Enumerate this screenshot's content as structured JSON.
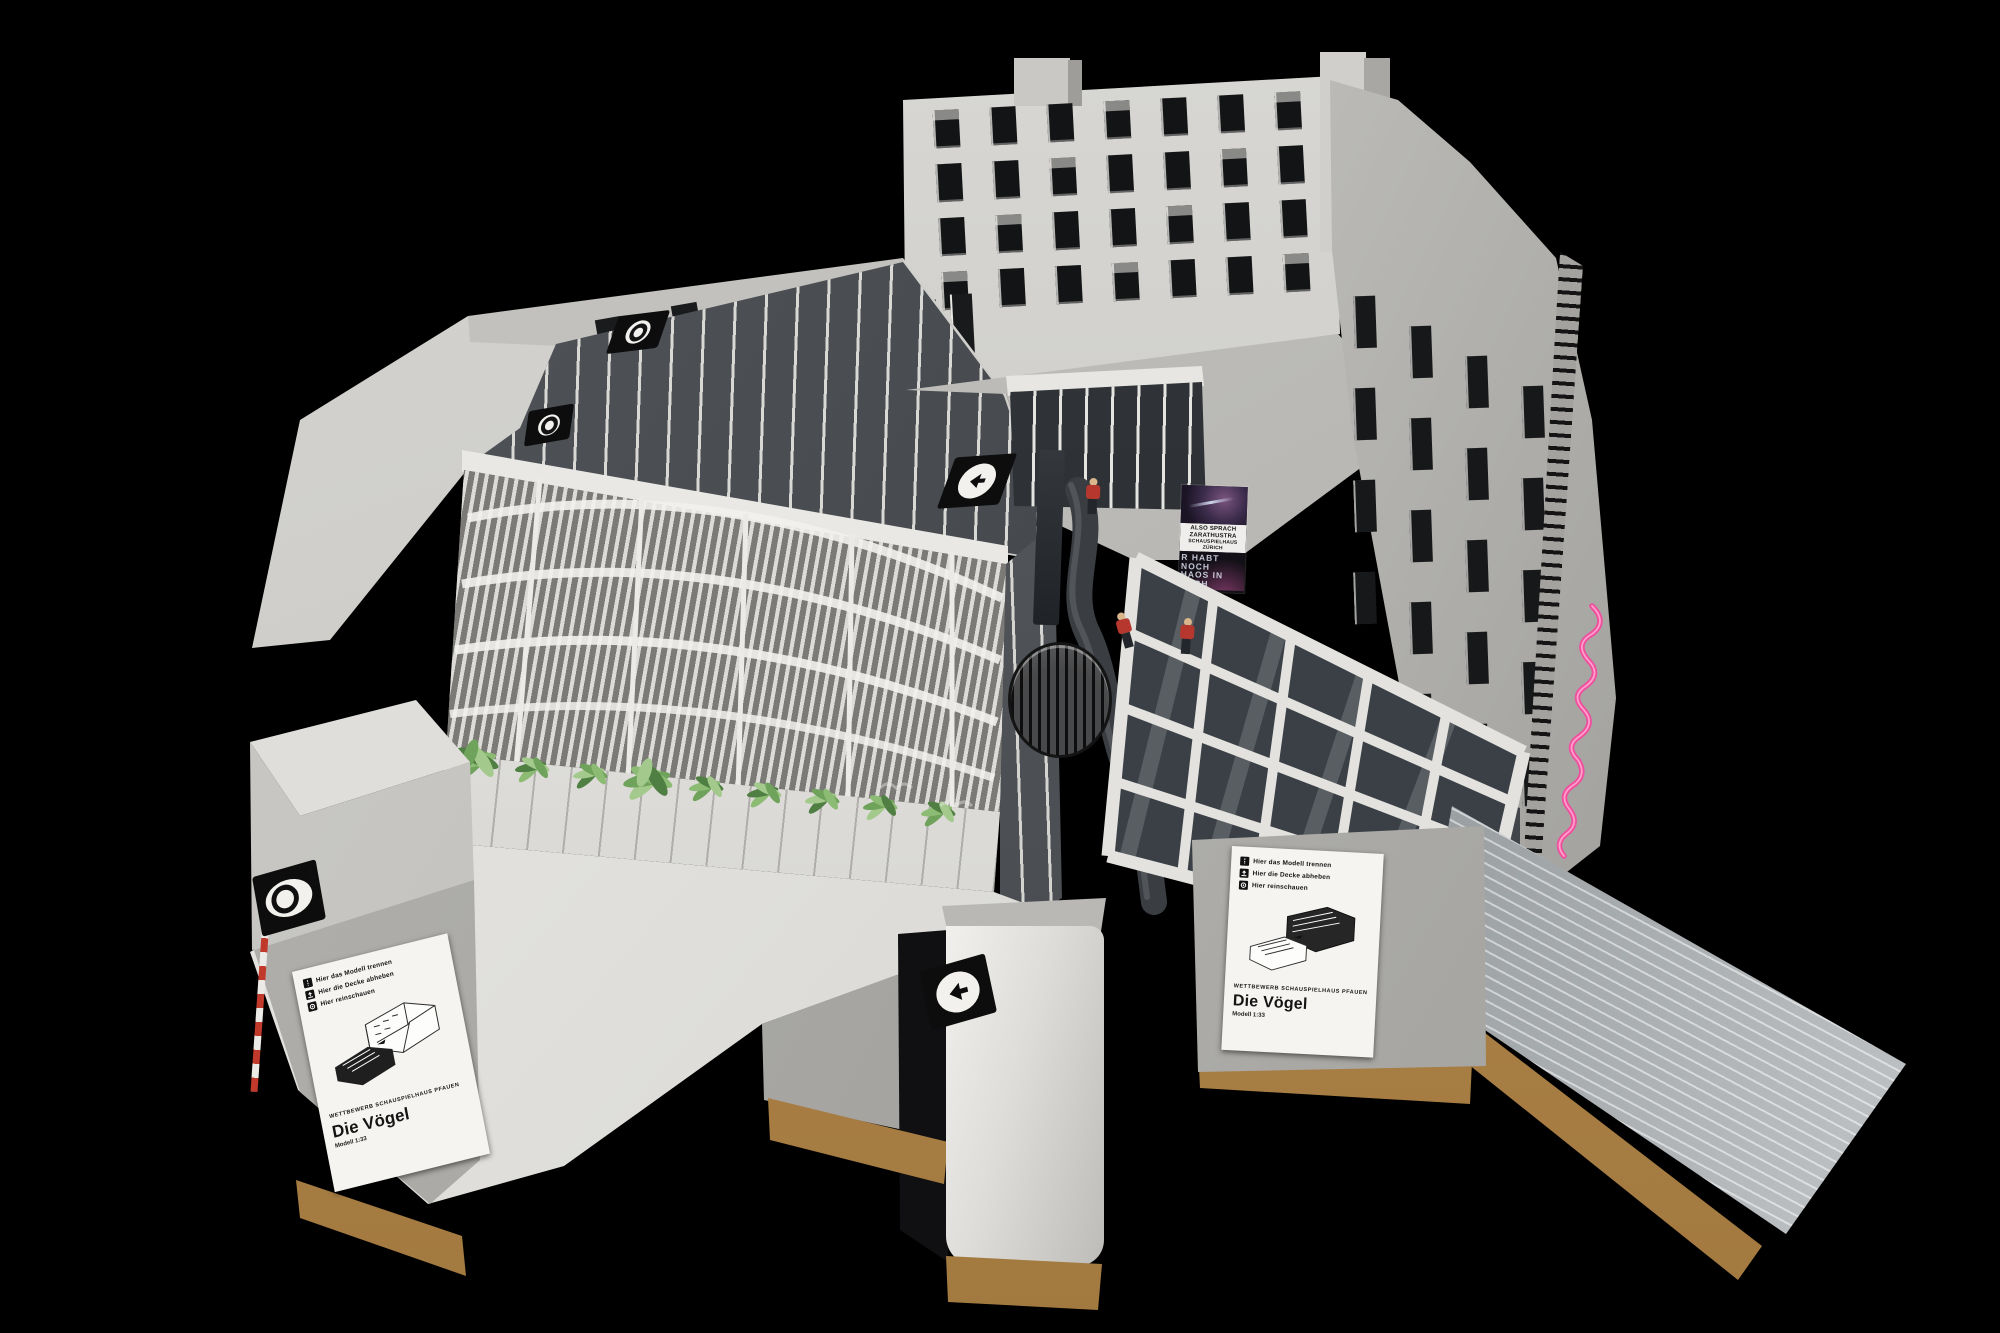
{
  "scene": {
    "background": "#000000",
    "subject": "Architekturmodell – Wettbewerb Schauspielhaus Pfauen, Projekt Die Vögel"
  },
  "placard_front": {
    "instructions": [
      {
        "icon": "detach-icon",
        "label": "Hier das Modell trennen"
      },
      {
        "icon": "lift-roof-icon",
        "label": "Hier die Decke abheben"
      },
      {
        "icon": "look-inside-icon",
        "label": "Hier reinschauen"
      }
    ],
    "competition": "WETTBEWERB SCHAUSPIELHAUS PFAUEN",
    "title": "Die Vögel",
    "scale": "Modell 1:33"
  },
  "placard_side": {
    "instructions": [
      {
        "icon": "detach-icon",
        "label": "Hier das Modell trennen"
      },
      {
        "icon": "lift-roof-icon",
        "label": "Hier die Decke abheben"
      },
      {
        "icon": "look-inside-icon",
        "label": "Hier reinschauen"
      }
    ],
    "competition": "WETTBEWERB SCHAUSPIELHAUS PFAUEN",
    "title": "Die Vögel",
    "scale": "Modell 1:33"
  },
  "poster": {
    "title_lines": [
      "ALSO SPRACH",
      "ZARATHUSTRA"
    ],
    "venue_lines": [
      "SCHAUSPIELHAUS",
      "ZÜRICH"
    ],
    "slogan_lines": [
      "R HABT",
      "NOCH",
      "HAOS IN",
      "EUCH"
    ]
  },
  "neon_sign": {
    "color": "#ef4f9e",
    "style": "cursive neon script, runs down facade edge (illegible)"
  },
  "figures": {
    "count": 3,
    "shirt_color": "#b5372e",
    "pants_color": "#23262b"
  },
  "icons": {
    "arrow_left_badge": "black plate, white disc, left arrow",
    "viewer_badge": "black plate, white disc, eye symbol"
  },
  "palette": {
    "board_light": "#d6d5d1",
    "board_mid": "#b9b8b4",
    "board_dark": "#8f8e8a",
    "glass_dark": "#343a40",
    "wood_base": "#a97f49",
    "foil": "#c6c9cc",
    "plant_green": "#6fa25a"
  }
}
